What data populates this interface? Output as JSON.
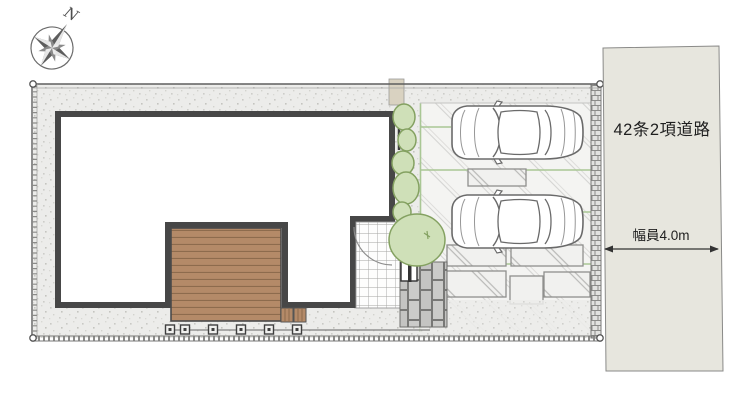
{
  "compass": {
    "north": "N"
  },
  "road": {
    "name": "42条2項道路",
    "width": "幅員4.0m"
  },
  "colors": {
    "ground": "#ececea",
    "wall": "#474747",
    "deck": "#b48a68",
    "deck_plank_line": "#8d6b4d",
    "tree_fill": "#cfe0b8",
    "tree_stroke": "#84a161",
    "parking": "#f4f4f2",
    "parking_joint_green": "#a9c795",
    "road_fill": "#e7e6de",
    "paver": "#c8c8c6",
    "gate": "#d9d2c1",
    "car_outline": "#6a6a6a"
  }
}
